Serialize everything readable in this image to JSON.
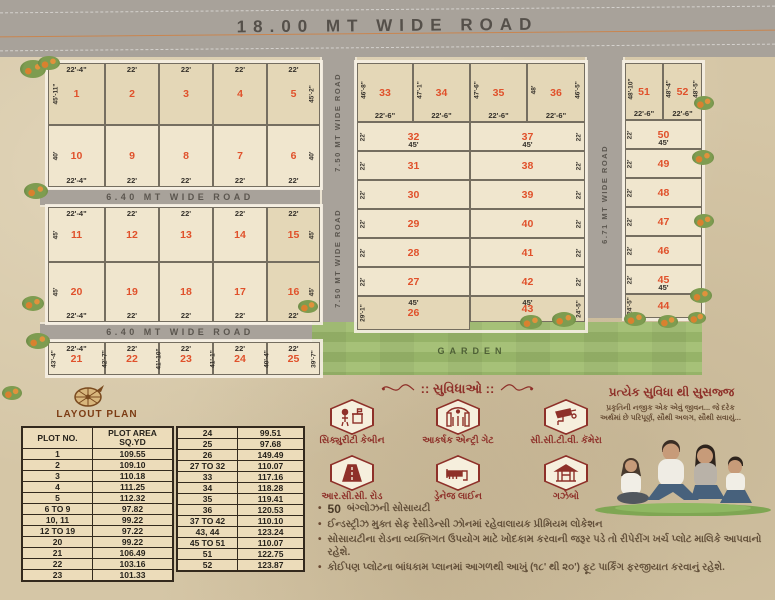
{
  "top_road": {
    "label": "18.00 MT WIDE ROAD"
  },
  "roads": {
    "r640": "6.40 MT WIDE ROAD",
    "r750": "7.50 MT WIDE ROAD",
    "r671": "6.71 MT WIDE ROAD"
  },
  "garden": {
    "label": "GARDEN"
  },
  "left_block": {
    "rows": [
      {
        "plots": [
          "1",
          "2",
          "3",
          "4",
          "5"
        ],
        "widths": [
          "22'-4\"",
          "22'",
          "22'",
          "22'",
          "22'"
        ],
        "label_pos": "top",
        "side_left": "45'-11\"",
        "side_right": "45'-2\""
      },
      {
        "plots": [
          "10",
          "9",
          "8",
          "7",
          "6"
        ],
        "widths": [
          "22'-4\"",
          "22'",
          "22'",
          "22'",
          "22'"
        ],
        "label_pos": "bottom",
        "side_left": "40'",
        "side_right": "40'"
      },
      {
        "plots": [
          "11",
          "12",
          "13",
          "14",
          "15"
        ],
        "widths": [
          "22'-4\"",
          "22'",
          "22'",
          "22'",
          "22'"
        ],
        "label_pos": "top",
        "side_left": "45'",
        "side_right": "45'"
      },
      {
        "plots": [
          "20",
          "19",
          "18",
          "17",
          "16"
        ],
        "widths": [
          "22'-4\"",
          "22'",
          "22'",
          "22'",
          "22'"
        ],
        "label_pos": "bottom",
        "side_left": "45'",
        "side_right": "45'"
      },
      {
        "plots": [
          "21",
          "22",
          "23",
          "24",
          "25"
        ],
        "widths": [
          "22'-4\"",
          "22'",
          "22'",
          "22'",
          "22'"
        ],
        "label_pos": "top",
        "boundary_dims": [
          "43'-4\"",
          "42'-7\"",
          "41'-10\"",
          "41'-1\"",
          "40'-4\"",
          "39'-7\""
        ]
      }
    ]
  },
  "mid_block": {
    "top_plots": [
      "33",
      "34",
      "35",
      "36"
    ],
    "top_width_label": "22'-6\"",
    "top_side_dims": [
      "46'-8\"",
      "47'-1\"",
      "47'-6\"",
      "48'"
    ],
    "top_side_right": "46'-5\"",
    "left_col": [
      "32",
      "31",
      "30",
      "29",
      "28",
      "27",
      "26"
    ],
    "right_col": [
      "37",
      "38",
      "39",
      "40",
      "41",
      "42",
      "43"
    ],
    "depth_label": "22'",
    "length_label": "45'",
    "p26_side": "29'-1\"",
    "p43_side": "24'-5\""
  },
  "right_block": {
    "top_plots": [
      "51",
      "52"
    ],
    "top_width_label": "22'-6\"",
    "top_side_dims": [
      "48'-10\"",
      "48'-4\""
    ],
    "top_side_right": "48'-5\"",
    "col": [
      "50",
      "49",
      "48",
      "47",
      "46",
      "45",
      "44"
    ],
    "depth_label": "22'",
    "length_label": "45'",
    "p44_side": "24'-5\""
  },
  "layout_plan": {
    "title": "LAYOUT PLAN",
    "table1": {
      "headers": [
        "PLOT NO.",
        "PLOT AREA SQ.YD"
      ],
      "rows": [
        [
          "1",
          "109.55"
        ],
        [
          "2",
          "109.10"
        ],
        [
          "3",
          "110.18"
        ],
        [
          "4",
          "111.25"
        ],
        [
          "5",
          "112.32"
        ],
        [
          "6 TO 9",
          "97.82"
        ],
        [
          "10, 11",
          "99.22"
        ],
        [
          "12 TO 19",
          "97.22"
        ],
        [
          "20",
          "99.22"
        ],
        [
          "21",
          "106.49"
        ],
        [
          "22",
          "103.16"
        ],
        [
          "23",
          "101.33"
        ]
      ]
    },
    "table2": {
      "rows": [
        [
          "24",
          "99.51"
        ],
        [
          "25",
          "97.68"
        ],
        [
          "26",
          "149.49"
        ],
        [
          "27 TO 32",
          "110.07"
        ],
        [
          "33",
          "117.16"
        ],
        [
          "34",
          "118.28"
        ],
        [
          "35",
          "119.41"
        ],
        [
          "36",
          "120.53"
        ],
        [
          "37 TO 42",
          "110.10"
        ],
        [
          "43, 44",
          "123.24"
        ],
        [
          "45 TO 51",
          "110.07"
        ],
        [
          "51",
          "122.75"
        ],
        [
          "52",
          "123.87"
        ]
      ]
    }
  },
  "amenities": {
    "title": ":: સુવિધાઓ ::",
    "items": [
      {
        "icon": "security-cabin-icon",
        "label": "સિક્યુરીટી કેબીન"
      },
      {
        "icon": "entry-gate-icon",
        "label": "આકર્ષક એન્ટ્રી ગેટ"
      },
      {
        "icon": "cctv-camera-icon",
        "label": "સી.સી.ટી.વી. કૅમેરા"
      },
      {
        "icon": "rcc-road-icon",
        "label": "આર.સી.સી. રોડ"
      },
      {
        "icon": "drainage-line-icon",
        "label": "ડ્રેનેજ લાઈન"
      },
      {
        "icon": "gazebo-icon",
        "label": "ગઝેબો"
      }
    ]
  },
  "promo": {
    "heading": "પ્રત્યેક સુવિધા થી સુસજ્જ",
    "sub_line1": "પ્રકૃતિની નજીક એક એવું જીવન... જે દરેક",
    "sub_line2": "અર્થમાં છે પરિપૂર્ણ, સૌથી અલગ, સૌથી સવાયું..."
  },
  "notes": [
    {
      "bold": "50",
      "text": "બંગ્લોઝની સોસાયટી"
    },
    {
      "text": "ઈન્ડસ્ટ્રીઝ મુક્ત સેફ રેસીડેન્સી ઝોનમાં રહેવાલાયક પ્રીમિયમ લોકેશન"
    },
    {
      "text": "સોસાયટીના રોડના વ્યક્તિગત ઉપયોગ માટે ખોદકામ કરવાની જરૂર પડે તો રીપેરીંગ ખર્ચ પ્લોટ માલિકે આપવાનો રહેશે."
    },
    {
      "text": "કોઈપણ પ્લોટના બાંધકામ પ્લાનમાં આગળથી આખું (૧૮' થી ૨૦') ફૂટ પાર્કિંગ ફરજીયાત કરવાનું રહેશે."
    }
  ],
  "colors": {
    "plot_number": "#e0512b",
    "maroon": "#8e3029",
    "road_gray": "#a8a29a",
    "garden_green": "#9fbd72",
    "paper": "#d5c6a6"
  }
}
